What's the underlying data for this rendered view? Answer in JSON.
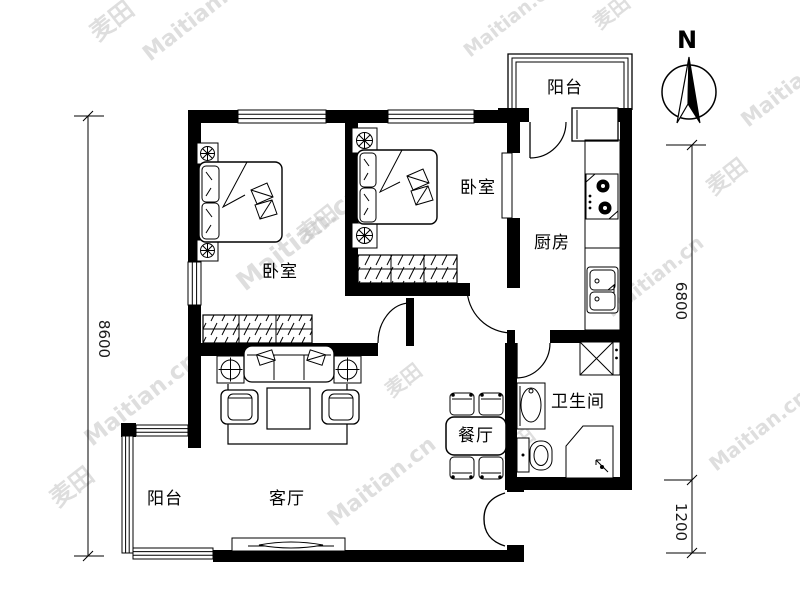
{
  "title": "两室户型图 (two-bedroom floor plan)",
  "rooms": {
    "bedroom1": "卧室",
    "bedroom2": "卧室",
    "kitchen": "厨房",
    "bathroom": "卫生间",
    "dining": "餐厅",
    "living": "客厅",
    "balcony_top": "阳台",
    "balcony_bottom": "阳台"
  },
  "dimensions": {
    "left": "8600",
    "right_upper": "6800",
    "right_lower": "1200"
  },
  "compass": {
    "north": "N"
  },
  "watermark": {
    "brand": "Maitian.cn",
    "logo": "麦田"
  },
  "colors": {
    "wall": "#000000",
    "line": "#1a1a1a",
    "background": "#ffffff",
    "watermark": "#bfbfbf"
  }
}
